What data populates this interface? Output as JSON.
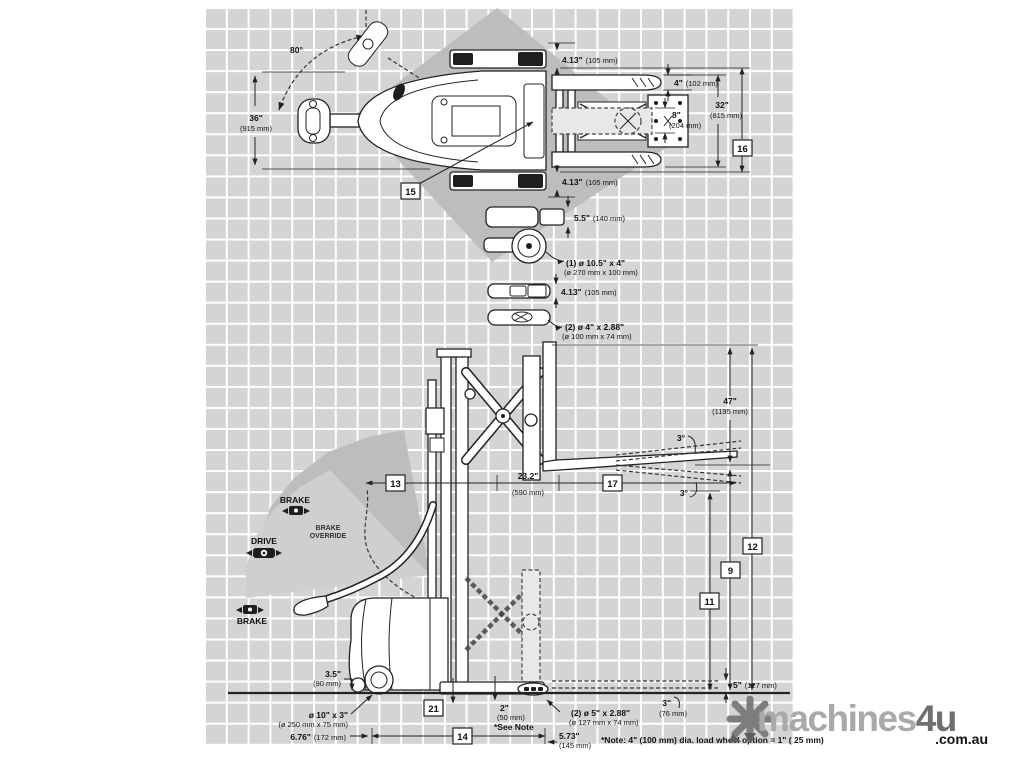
{
  "colors": {
    "grid_cell": "#d4d4d4",
    "shade_dark": "#bdbdbd",
    "shade_light": "#cfcfcf",
    "line": "#222222",
    "watermark_light": "#a9a9a9",
    "watermark_dark": "#6f6f6f"
  },
  "top_view": {
    "swing_angle": "80°",
    "tiller_width_in": "36\"",
    "tiller_width_mm": "(915 mm)",
    "outrigger_top_in": "4.13\"",
    "outrigger_top_mm": "(105 mm)",
    "fork_thickness_in": "4\"",
    "fork_thickness_mm": "(102 mm)",
    "inner_spread_in": "8\"",
    "inner_spread_mm": "(204 mm)",
    "fork_spread_in": "32\"",
    "fork_spread_mm": "(815 mm)",
    "outrigger_bottom_in": "4.13\"",
    "outrigger_bottom_mm": "(105 mm)",
    "drive_tire_width_in": "5.5\"",
    "drive_tire_width_mm": "(140 mm)",
    "drive_tire_size": "(1) ø 10.5\" x 4\"",
    "drive_tire_size_mm": "(ø 270 mm x 100 mm)",
    "caster_width_in": "4.13\"",
    "caster_width_mm": "(105 mm)",
    "load_wheel_size": "(2) ø 4\" x 2.88\"",
    "load_wheel_size_mm": "(ø 100 mm x 74 mm)"
  },
  "side_view": {
    "brake_top": "BRAKE",
    "brake_override_line1": "BRAKE",
    "brake_override_line2": "OVERRIDE",
    "drive": "DRIVE",
    "brake_bottom": "BRAKE",
    "reach_in": "23.2\"",
    "reach_mm": "(590 mm)",
    "tilt_up": "3°",
    "tilt_down": "3°",
    "lift_height_in": "47\"",
    "lift_height_mm": "(1195 mm)",
    "underclearance_in": "3.5\"",
    "underclearance_mm": "(90 mm)",
    "drive_wheel_size": "ø 10\" x 3\"",
    "drive_wheel_size_mm": "(ø 250 mm x 75 mm)",
    "front_to_wheel_in": "6.76\"",
    "front_to_wheel_mm": "(172 mm)",
    "gap_in": "2\"",
    "gap_mm": "(50 mm)",
    "see_note": "*See Note",
    "load_wheel_size": "(2) ø 5\" x 2.88\"",
    "load_wheel_size_mm": "(ø 127 mm x 74 mm)",
    "overhang_in": "5.73\"",
    "overhang_mm": "(145 mm)",
    "lowered_height_in": "5\"",
    "lowered_height_mm": "(127 mm)",
    "tip_height_in": "3\"",
    "tip_height_mm": "(76 mm)",
    "note": "*Note: 4\" (100 mm) dia. load wheel option = 1\" ( 25 mm)"
  },
  "markers": {
    "m9": "9",
    "m11": "11",
    "m12": "12",
    "m13": "13",
    "m14": "14",
    "m15": "15",
    "m16": "16",
    "m17": "17",
    "m21": "21"
  },
  "watermark": {
    "name": "machines",
    "suffix": "4u",
    "domain": ".com.au"
  }
}
